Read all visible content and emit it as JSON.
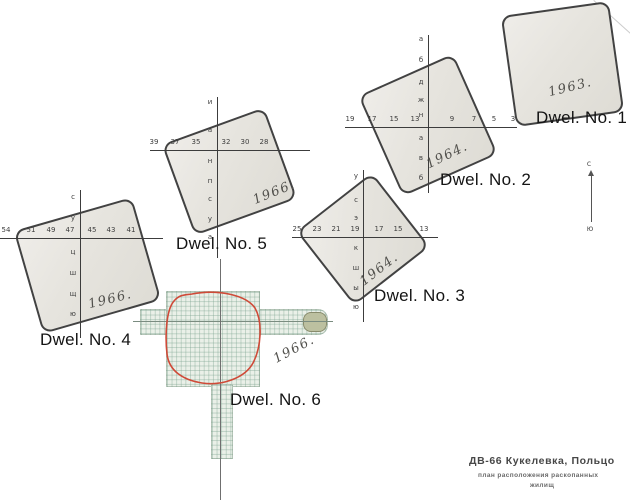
{
  "dwellings": [
    {
      "label": "Dwel. No. 1",
      "year": "1963."
    },
    {
      "label": "Dwel. No. 2",
      "year": "1964.",
      "xticks": [
        "19",
        "17",
        "15",
        "13",
        "9",
        "7",
        "5",
        "3"
      ],
      "yletters": [
        "а",
        "б",
        "д",
        "ж",
        "н",
        "а",
        "в",
        "б"
      ]
    },
    {
      "label": "Dwel. No. 3",
      "year": "1964.",
      "xticks": [
        "25",
        "23",
        "21",
        "19",
        "17",
        "15",
        "13"
      ],
      "yletters": [
        "у",
        "с",
        "э",
        "к",
        "ш",
        "ы",
        "ю"
      ]
    },
    {
      "label": "Dwel. No. 4",
      "year": "1966.",
      "xticks": [
        "54",
        "51",
        "49",
        "47",
        "45",
        "43",
        "41"
      ],
      "yletters": [
        "с",
        "у",
        "ц",
        "ш",
        "щ",
        "ю"
      ]
    },
    {
      "label": "Dwel. No. 5",
      "year": "1966.",
      "xticks": [
        "39",
        "37",
        "35",
        "32",
        "30",
        "28"
      ],
      "yletters": [
        "и",
        "а",
        "н",
        "п",
        "с",
        "у",
        "а"
      ]
    },
    {
      "label": "Dwel. No. 6",
      "year": "1966."
    }
  ],
  "compass": {
    "north": "с",
    "south": "ю"
  },
  "title_block": {
    "line1": "ДВ-66  Кукелевка, Польцо",
    "line2": "план расположения раскопанных",
    "line3": "жилищ"
  }
}
